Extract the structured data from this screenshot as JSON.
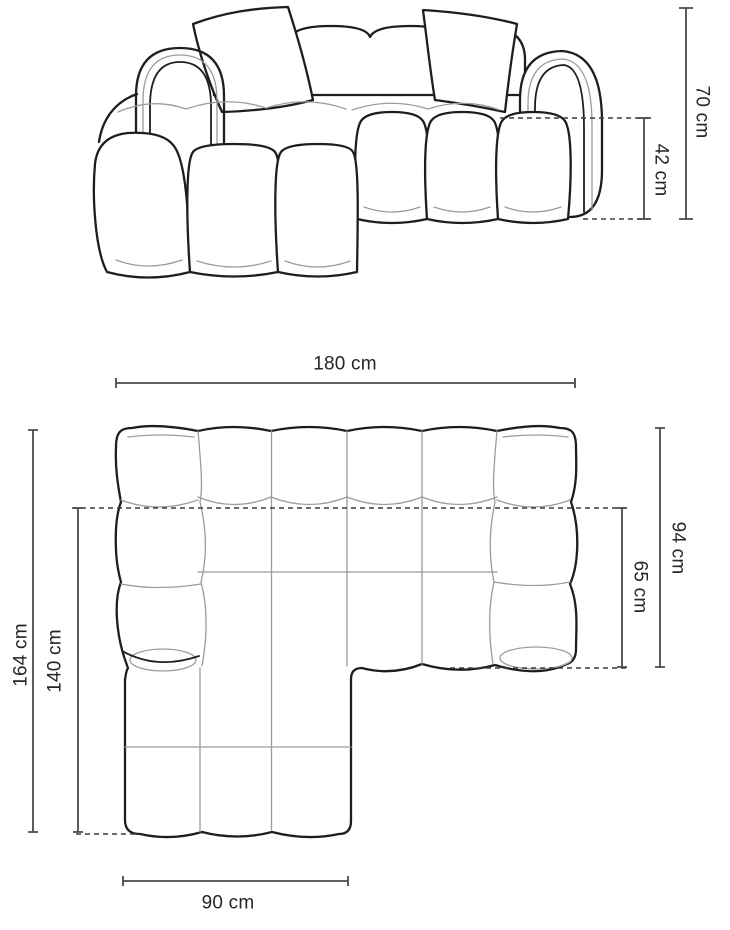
{
  "page": {
    "background": "#ffffff",
    "unit": "cm"
  },
  "colors": {
    "outline": "#1e1e1e",
    "inner-line": "#9c9c9c",
    "dim-line": "#4a4a4a",
    "dash-line": "#3c3c3c",
    "label-text": "#262626",
    "background": "#ffffff"
  },
  "front_view": {
    "dimensions": {
      "total_height": {
        "label": "70 cm",
        "value": 70,
        "unit": "cm"
      },
      "seat_height": {
        "label": "42 cm",
        "value": 42,
        "unit": "cm"
      }
    }
  },
  "top_view": {
    "dimensions": {
      "total_width": {
        "label": "180 cm",
        "value": 180,
        "unit": "cm"
      },
      "total_depth": {
        "label": "164 cm",
        "value": 164,
        "unit": "cm"
      },
      "inner_depth": {
        "label": "140 cm",
        "value": 140,
        "unit": "cm"
      },
      "body_depth": {
        "label": "94 cm",
        "value": 94,
        "unit": "cm"
      },
      "seat_depth": {
        "label": "65 cm",
        "value": 65,
        "unit": "cm"
      },
      "chaise_width": {
        "label": "90 cm",
        "value": 90,
        "unit": "cm"
      }
    }
  }
}
